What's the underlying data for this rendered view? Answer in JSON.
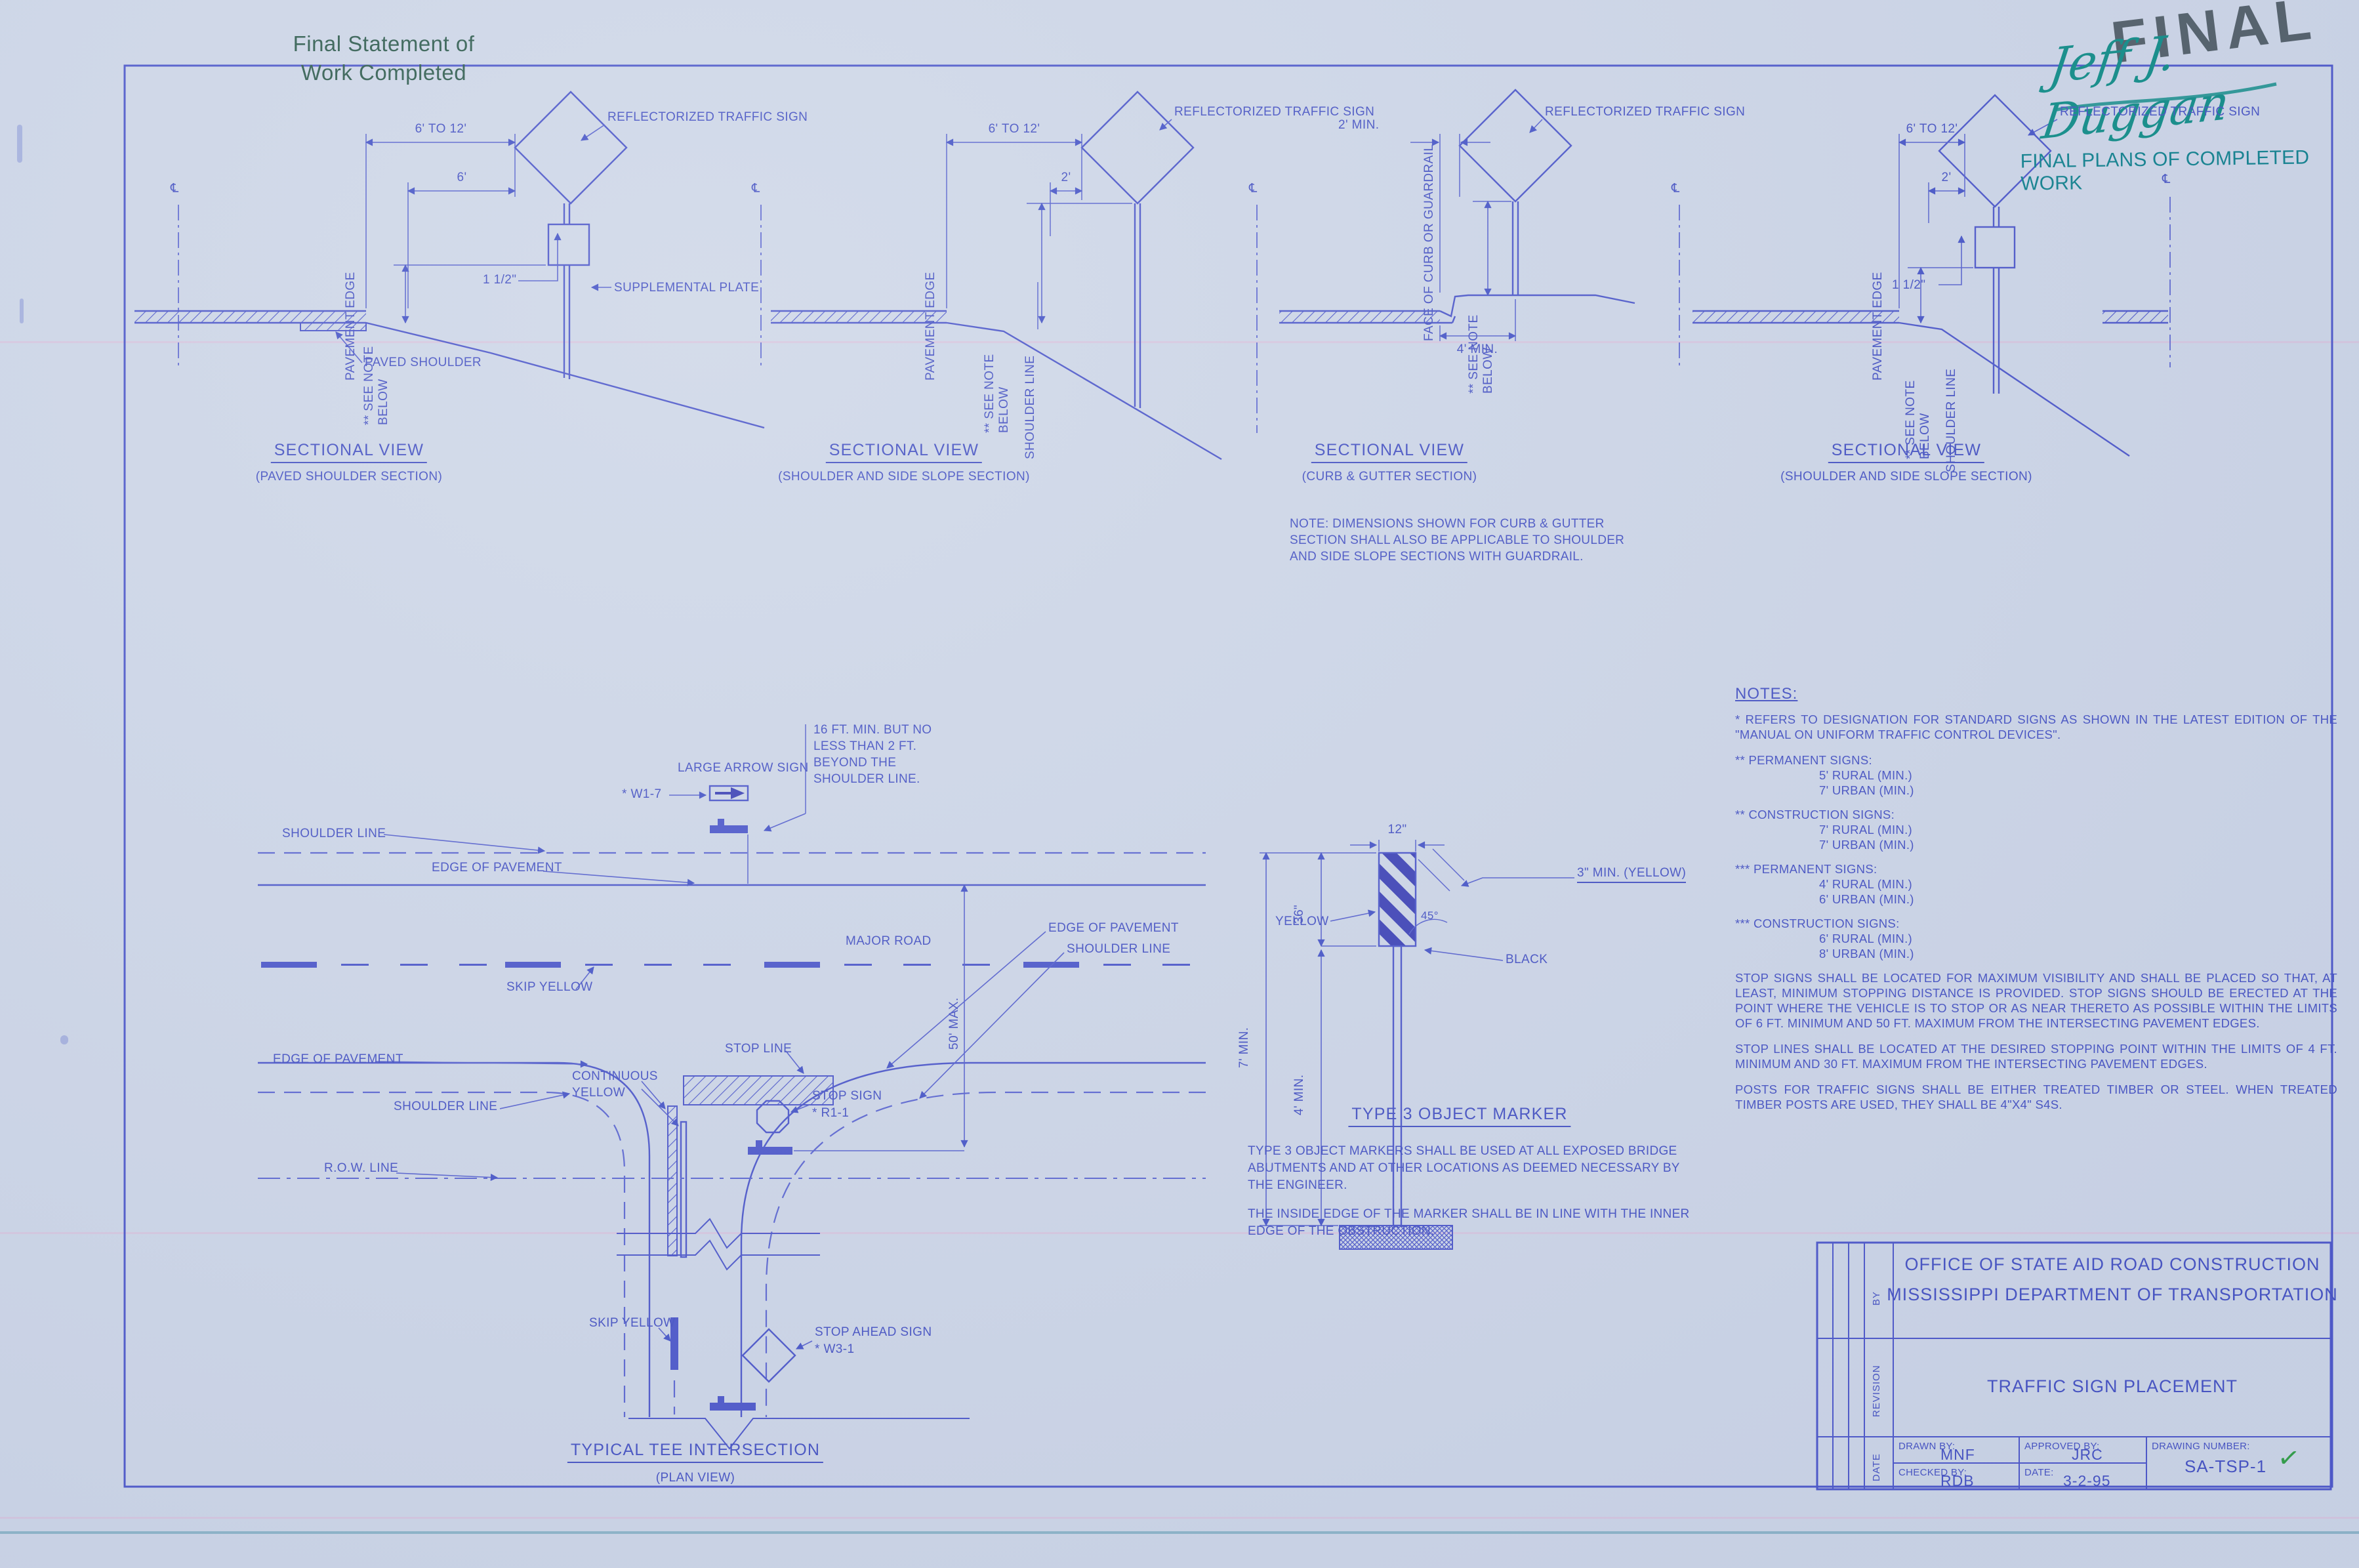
{
  "stamps": {
    "final_statement_1": "Final Statement of",
    "final_statement_2": "Work Completed",
    "final": "FINAL",
    "signature": "Jeff J. Duggan",
    "final_plans": "FINAL PLANS OF COMPLETED WORK"
  },
  "cl_symbol": "℄",
  "views": {
    "v1": {
      "title": "SECTIONAL VIEW",
      "subtitle": "(PAVED SHOULDER SECTION)",
      "dim_a": "6' TO 12'",
      "dim_b": "6'",
      "dim_c": "1 1/2\"",
      "sign": "REFLECTORIZED TRAFFIC SIGN",
      "plate": "SUPPLEMENTAL PLATE",
      "pavement_edge": "PAVEMENT EDGE",
      "see_note_1": "** SEE NOTE",
      "see_note_2": "BELOW",
      "paved_shoulder": "PAVED SHOULDER"
    },
    "v2": {
      "title": "SECTIONAL VIEW",
      "subtitle": "(SHOULDER AND SIDE SLOPE SECTION)",
      "dim_a": "6' TO 12'",
      "dim_b": "2'",
      "sign": "REFLECTORIZED TRAFFIC SIGN",
      "pavement_edge": "PAVEMENT EDGE",
      "see_note_1": "** SEE NOTE",
      "see_note_2": "BELOW",
      "shoulder_line": "SHOULDER LINE"
    },
    "v3": {
      "title": "SECTIONAL VIEW",
      "subtitle": "(CURB & GUTTER SECTION)",
      "dim_a": "2' MIN.",
      "dim_b": "4' MIN.",
      "sign": "REFLECTORIZED TRAFFIC SIGN",
      "curb_face": "FACE OF CURB OR GUARDRAIL",
      "see_note_1": "** SEE NOTE",
      "see_note_2": "BELOW",
      "note_1": "NOTE: DIMENSIONS SHOWN FOR CURB & GUTTER",
      "note_2": "SECTION SHALL ALSO BE APPLICABLE TO SHOULDER",
      "note_3": "AND SIDE SLOPE SECTIONS WITH GUARDRAIL."
    },
    "v4": {
      "title": "SECTIONAL VIEW",
      "subtitle": "(SHOULDER AND SIDE SLOPE SECTION)",
      "dim_a": "6' TO 12'",
      "dim_b": "2'",
      "dim_c": "1 1/2\"",
      "sign": "REFLECTORIZED TRAFFIC SIGN",
      "pavement_edge": "PAVEMENT EDGE",
      "see_note_1": "** SEE NOTE",
      "see_note_2": "BELOW",
      "shoulder_line": "SHOULDER LINE"
    }
  },
  "plan": {
    "title": "TYPICAL TEE INTERSECTION",
    "subtitle": "(PLAN VIEW)",
    "shoulder_line_top": "SHOULDER LINE",
    "edge_of_pavement_top": "EDGE OF PAVEMENT",
    "large_arrow_sign": "LARGE ARROW SIGN",
    "w1_7": "* W1-7",
    "setback_1": "16 FT. MIN. BUT NO",
    "setback_2": "LESS THAN 2 FT.",
    "setback_3": "BEYOND THE",
    "setback_4": "SHOULDER LINE.",
    "major_road": "MAJOR ROAD",
    "skip_yellow_top": "SKIP YELLOW",
    "edge_of_pavement_left": "EDGE OF PAVEMENT",
    "continuous_yellow_1": "CONTINUOUS",
    "continuous_yellow_2": "YELLOW",
    "stop_line": "STOP LINE",
    "shoulder_line_left": "SHOULDER LINE",
    "edge_of_pavement_right": "EDGE OF PAVEMENT",
    "shoulder_line_right": "SHOULDER LINE",
    "row_line": "R.O.W. LINE",
    "stop_sign_1": "STOP SIGN",
    "stop_sign_2": "* R1-1",
    "dim_50": "50' MAX.",
    "skip_yellow_bottom": "SKIP YELLOW",
    "stop_ahead_1": "STOP AHEAD SIGN",
    "stop_ahead_2": "* W3-1"
  },
  "marker": {
    "dim_width": "12\"",
    "dim_36": "36\"",
    "dim_7": "7' MIN.",
    "dim_4": "4' MIN.",
    "yellow": "YELLOW",
    "black": "BLACK",
    "stripe_note": "3\" MIN. (YELLOW)",
    "angle": "45°",
    "title": "TYPE 3 OBJECT MARKER",
    "p1_1": "TYPE 3 OBJECT MARKERS SHALL BE USED AT ALL EXPOSED BRIDGE",
    "p1_2": "ABUTMENTS AND AT OTHER LOCATIONS AS DEEMED NECESSARY BY",
    "p1_3": "THE ENGINEER.",
    "p2_1": "THE INSIDE EDGE OF THE MARKER SHALL BE IN LINE WITH THE INNER",
    "p2_2": "EDGE OF THE OBSTRUCTION."
  },
  "notes": {
    "heading": "NOTES:",
    "ref_note": "* REFERS TO DESIGNATION FOR STANDARD SIGNS AS SHOWN IN THE LATEST EDITION OF THE \"MANUAL ON UNIFORM TRAFFIC CONTROL DEVICES\".",
    "groups": [
      {
        "head": "** PERMANENT SIGNS:",
        "lines": [
          "5' RURAL (MIN.)",
          "7' URBAN (MIN.)"
        ]
      },
      {
        "head": "** CONSTRUCTION SIGNS:",
        "lines": [
          "7' RURAL (MIN.)",
          "7' URBAN (MIN.)"
        ]
      },
      {
        "head": "*** PERMANENT SIGNS:",
        "lines": [
          "4' RURAL (MIN.)",
          "6' URBAN (MIN.)"
        ]
      },
      {
        "head": "*** CONSTRUCTION SIGNS:",
        "lines": [
          "6' RURAL (MIN.)",
          "8' URBAN (MIN.)"
        ]
      }
    ],
    "para_stop_signs": "STOP SIGNS SHALL BE LOCATED FOR MAXIMUM VISIBILITY AND SHALL BE PLACED SO THAT, AT LEAST, MINIMUM STOPPING DISTANCE IS PROVIDED.  STOP SIGNS SHOULD BE ERECTED AT THE POINT WHERE THE VEHICLE IS TO STOP OR AS NEAR THERETO AS POSSIBLE WITHIN THE LIMITS OF 6 FT. MINIMUM AND 50 FT. MAXIMUM FROM THE INTERSECTING PAVEMENT EDGES.",
    "para_stop_lines": "STOP LINES SHALL BE LOCATED AT THE DESIRED STOPPING POINT WITHIN THE LIMITS OF 4 FT. MINIMUM AND 30 FT. MAXIMUM FROM THE INTERSECTING PAVEMENT EDGES.",
    "para_posts": "POSTS FOR TRAFFIC SIGNS SHALL BE EITHER TREATED TIMBER OR STEEL.  WHEN TREATED TIMBER POSTS ARE USED, THEY SHALL BE 4\"X4\" S4S."
  },
  "titleblock": {
    "agency_1": "OFFICE OF STATE AID ROAD CONSTRUCTION",
    "agency_2": "MISSISSIPPI DEPARTMENT OF TRANSPORTATION",
    "sheet_title": "TRAFFIC SIGN PLACEMENT",
    "col_by": "BY",
    "col_revision": "REVISION",
    "col_date": "DATE",
    "drawn_by_label": "DRAWN BY:",
    "drawn_by": "MNF",
    "approved_by_label": "APPROVED BY:",
    "approved_by": "JRC",
    "checked_by_label": "CHECKED BY:",
    "checked_by": "RDB",
    "date_label": "DATE:",
    "date": "3-2-95",
    "drawing_number_label": "DRAWING NUMBER:",
    "drawing_number": "SA-TSP-1",
    "check": "✓"
  }
}
